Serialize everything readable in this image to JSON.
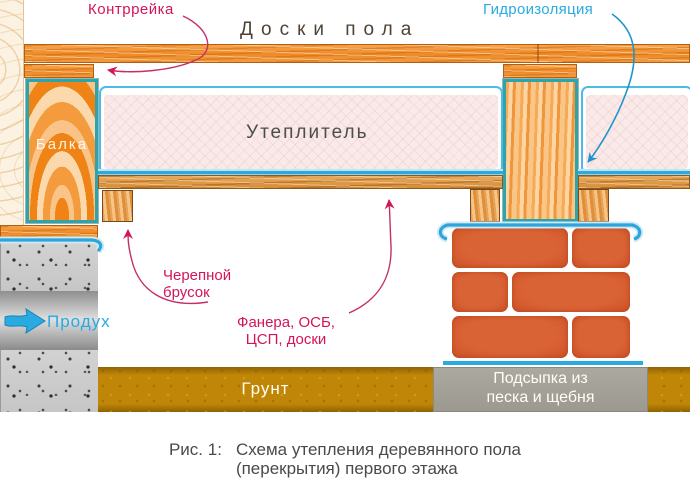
{
  "figure": {
    "labels": {
      "counter_batten": "Контррейка",
      "floor_boards": "Доски пола",
      "waterproofing": "Гидроизоляция",
      "beam": "Балка",
      "insulation": "Утеплитель",
      "skull_block_line1": "Черепной",
      "skull_block_line2": "брусок",
      "sheathing_line1": "Фанера, ОСБ,",
      "sheathing_line2": "ЦСП, доски",
      "vent": "Продух",
      "ground": "Грунт",
      "bedding_line1": "Подсыпка из",
      "bedding_line2": "песка и щебня"
    },
    "caption": {
      "figure_number": "Рис. 1:",
      "line1": "Схема утепления деревянного пола",
      "line2": "(перекрытия) первого этажа"
    },
    "colors": {
      "pink_label": "#D4145A",
      "cyan_label": "#29ABE2",
      "dark_text": "#4D4D4D",
      "wood_orange": "#F7931E",
      "teal_border": "#2EA3A8",
      "insulation_fill": "#FAE9E9",
      "brick": "#D4582B",
      "ground_gold": "#BF8607",
      "concrete_gray": "#CBCBCB",
      "bedding_gray": "#A4A198"
    },
    "icons": {
      "vent_arrow": "right-arrow",
      "leader_pink": "curved-arrow",
      "leader_cyan": "curved-arrow"
    }
  }
}
